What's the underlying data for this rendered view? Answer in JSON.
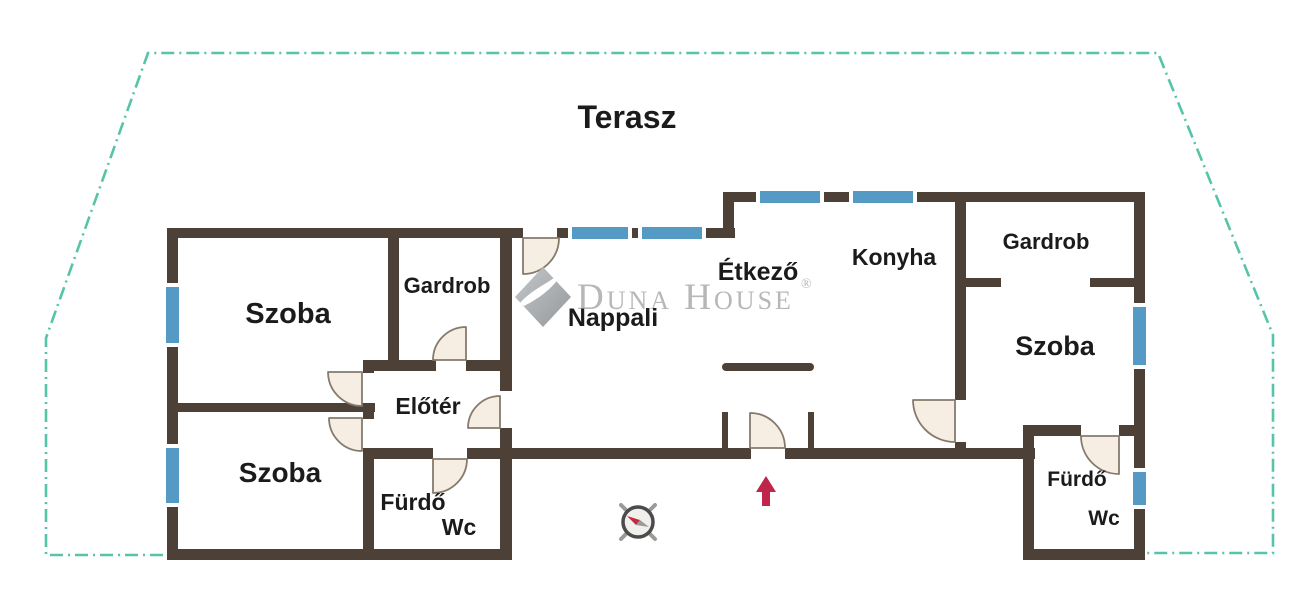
{
  "plan": {
    "title": "Terasz",
    "watermark": {
      "brand": "Duna House",
      "registered": "®"
    },
    "labels": {
      "terasz": "Terasz",
      "szoba_upper_left": "Szoba",
      "gardrob_left": "Gardrob",
      "eloter": "Előtér",
      "szoba_lower_left": "Szoba",
      "furdo_left": "Fürdő",
      "wc_left": "Wc",
      "nappali": "Nappali",
      "etkezo": "Étkező",
      "konyha": "Konyha",
      "gardrob_right": "Gardrob",
      "szoba_right": "Szoba",
      "furdo_right": "Fürdő",
      "wc_right": "Wc"
    },
    "colors": {
      "wall": "#4c4037",
      "window": "#5599c5",
      "terrace_outline": "#55c4a8",
      "door_fill": "#f7eee3",
      "door_stroke": "#857a6d",
      "entrance_arrow": "#c02649",
      "watermark": "#b4b4b4",
      "label_text": "#1b1b1b",
      "compass_ring": "#4b4b4b"
    },
    "icons": {
      "compass": "compass-icon",
      "entrance_arrow": "entrance-arrow-icon",
      "door": "door-arc-icon",
      "window": "window-segment",
      "brand_diamond": "brand-diamond-icon"
    }
  }
}
